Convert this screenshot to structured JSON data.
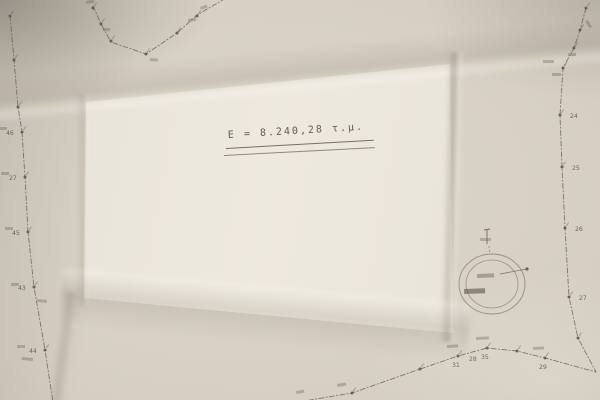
{
  "paper": {
    "base_color": "#d2cbbe",
    "panel_color": "#eae5da",
    "ink_color": "#5c5346",
    "faint_ink_color": "#7a7062"
  },
  "area_annotation": {
    "text": "E = 8.240,28 τ.μ."
  },
  "boundary": {
    "style": "dash-dot",
    "chains": [
      {
        "name": "top-boundary",
        "pts": [
          [
            93,
            6
          ],
          [
            101,
            24
          ],
          [
            111,
            42
          ],
          [
            146,
            54
          ],
          [
            177,
            33
          ],
          [
            197,
            15
          ],
          [
            233,
            -6
          ]
        ]
      },
      {
        "name": "left-boundary",
        "pts": [
          [
            10,
            16
          ],
          [
            14,
            60
          ],
          [
            18,
            107
          ],
          [
            22,
            132
          ],
          [
            25,
            177
          ],
          [
            28,
            232
          ],
          [
            34,
            287
          ],
          [
            45,
            350
          ],
          [
            53,
            402
          ]
        ]
      },
      {
        "name": "right-boundary",
        "pts": [
          [
            586,
            8
          ],
          [
            580,
            30
          ],
          [
            574,
            48
          ],
          [
            563,
            68
          ],
          [
            560,
            115
          ],
          [
            562,
            167
          ],
          [
            565,
            228
          ],
          [
            569,
            297
          ],
          [
            578,
            338
          ],
          [
            596,
            372
          ]
        ]
      },
      {
        "name": "bottom-boundary",
        "pts": [
          [
            298,
            402
          ],
          [
            352,
            393
          ],
          [
            420,
            369
          ],
          [
            458,
            356
          ],
          [
            487,
            348
          ],
          [
            517,
            351
          ],
          [
            545,
            358
          ],
          [
            596,
            372
          ]
        ]
      }
    ],
    "points": [
      {
        "x": 93,
        "y": 8
      },
      {
        "x": 101,
        "y": 24
      },
      {
        "x": 111,
        "y": 41
      },
      {
        "x": 146,
        "y": 54
      },
      {
        "x": 177,
        "y": 33
      },
      {
        "x": 197,
        "y": 16
      },
      {
        "x": 10,
        "y": 16
      },
      {
        "x": 14,
        "y": 60
      },
      {
        "x": 18,
        "y": 107
      },
      {
        "x": 22,
        "y": 132,
        "label": "46",
        "lx": 6,
        "ly": 135
      },
      {
        "x": 25,
        "y": 177,
        "label": "27",
        "lx": 9,
        "ly": 180
      },
      {
        "x": 28,
        "y": 232,
        "label": "45",
        "lx": 12,
        "ly": 235
      },
      {
        "x": 34,
        "y": 287,
        "label": "43",
        "lx": 18,
        "ly": 290
      },
      {
        "x": 45,
        "y": 350,
        "label": "44",
        "lx": 29,
        "ly": 353
      },
      {
        "x": 586,
        "y": 8
      },
      {
        "x": 580,
        "y": 30
      },
      {
        "x": 574,
        "y": 48
      },
      {
        "x": 563,
        "y": 68
      },
      {
        "x": 560,
        "y": 115,
        "label": "24",
        "lx": 570,
        "ly": 118
      },
      {
        "x": 562,
        "y": 167,
        "label": "25",
        "lx": 572,
        "ly": 170
      },
      {
        "x": 565,
        "y": 228,
        "label": "26",
        "lx": 575,
        "ly": 231
      },
      {
        "x": 569,
        "y": 297,
        "label": "27",
        "lx": 579,
        "ly": 300
      },
      {
        "x": 578,
        "y": 338
      },
      {
        "x": 352,
        "y": 393
      },
      {
        "x": 420,
        "y": 369
      },
      {
        "x": 458,
        "y": 356,
        "label": "31",
        "lx": 452,
        "ly": 367
      },
      {
        "x": 487,
        "y": 348,
        "label": "35",
        "lx": 481,
        "ly": 359
      },
      {
        "x": 517,
        "y": 351
      },
      {
        "x": 545,
        "y": 358,
        "label": "29",
        "lx": 539,
        "ly": 369
      }
    ],
    "segment_labels": [
      {
        "x": 469,
        "y": 361,
        "text": "28"
      }
    ],
    "smudges": [
      {
        "x": 86,
        "y": 1,
        "w": 8,
        "h": 3,
        "r": -10
      },
      {
        "x": 103,
        "y": 28,
        "w": 7,
        "h": 3,
        "r": 0
      },
      {
        "x": 150,
        "y": 58,
        "w": 8,
        "h": 3,
        "r": 5
      },
      {
        "x": 188,
        "y": 19,
        "w": 8,
        "h": 3,
        "r": -8
      },
      {
        "x": 200,
        "y": 7,
        "w": 7,
        "h": 3,
        "r": -20
      },
      {
        "x": 0,
        "y": 127,
        "w": 7,
        "h": 3,
        "r": 0
      },
      {
        "x": 1,
        "y": 172,
        "w": 8,
        "h": 3,
        "r": 0
      },
      {
        "x": 5,
        "y": 227,
        "w": 8,
        "h": 3,
        "r": 0
      },
      {
        "x": 11,
        "y": 283,
        "w": 8,
        "h": 3,
        "r": 0
      },
      {
        "x": 17,
        "y": 345,
        "w": 8,
        "h": 3,
        "r": 0
      },
      {
        "x": 22,
        "y": 357,
        "w": 11,
        "h": 3,
        "r": 5
      },
      {
        "x": 37,
        "y": 299,
        "w": 10,
        "h": 3,
        "r": 5
      },
      {
        "x": 543,
        "y": 60,
        "w": 11,
        "h": 3,
        "r": 0
      },
      {
        "x": 552,
        "y": 73,
        "w": 9,
        "h": 3,
        "r": 0
      },
      {
        "x": 568,
        "y": 53,
        "w": 8,
        "h": 3,
        "r": 0
      },
      {
        "x": 588,
        "y": 20,
        "w": 8,
        "h": 3,
        "r": 60
      },
      {
        "x": 447,
        "y": 345,
        "w": 11,
        "h": 3,
        "r": -3
      },
      {
        "x": 476,
        "y": 337,
        "w": 13,
        "h": 3,
        "r": -3
      },
      {
        "x": 533,
        "y": 347,
        "w": 11,
        "h": 3,
        "r": -3
      },
      {
        "x": 337,
        "y": 384,
        "w": 9,
        "h": 3,
        "r": -10
      },
      {
        "x": 296,
        "y": 391,
        "w": 8,
        "h": 3,
        "r": -10
      },
      {
        "x": 480,
        "y": 238,
        "w": 11,
        "h": 3,
        "r": 0
      }
    ]
  },
  "detail_circle": {
    "cx": 492,
    "cy": 284,
    "outer_rx": 33,
    "outer_ry": 30,
    "inner_rx": 26,
    "inner_ry": 24,
    "pointer": {
      "x1": 500,
      "y1": 274,
      "x2": 527,
      "y2": 269
    },
    "top_tick": {
      "x": 487,
      "y1": 230,
      "y2": 244
    },
    "leader_dash": {
      "x1": 489,
      "y1": 246,
      "x2": 490,
      "y2": 254
    },
    "interior_smudges": [
      {
        "x": 477,
        "y": 274,
        "w": 17,
        "h": 4,
        "r": -2,
        "o": 0.4
      },
      {
        "x": 464,
        "y": 289,
        "w": 21,
        "h": 5,
        "r": -2,
        "o": 0.6
      }
    ]
  }
}
